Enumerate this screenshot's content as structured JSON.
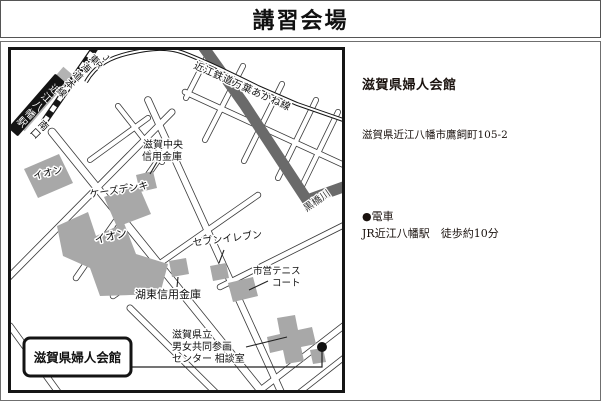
{
  "title": "講習会場",
  "info_panel": {
    "name": "滋賀県婦人会館",
    "address": "滋賀県近江八幡市鷹飼町105-2",
    "access_heading": "●電車",
    "access_detail": "JR近江八幡駅　徒歩約10分"
  },
  "map": {
    "venue_label": "滋賀県婦人会館",
    "station_label": "近江八幡駅",
    "south_exit_label": "南口",
    "jr_prefix": "JR",
    "jr_line_label": "東海道本線",
    "ohmi_line_label": "近江鉄道万葉あかね線",
    "river_label": "黒橋川",
    "labels": {
      "aeon_small": "イオン",
      "aeon_big": "イオン",
      "ks_denki": "ケーズデンキ",
      "chuo_shinkin_1": "滋賀中央",
      "chuo_shinkin_2": "信用金庫",
      "seven_eleven": "セブンイレブン",
      "tennis_1": "市営テニス",
      "tennis_2": "コート",
      "koto_shinkin": "湖東信用金庫",
      "center_1": "滋賀県立",
      "center_2": "男女共同参画",
      "center_3": "センター 相談室"
    },
    "colors": {
      "building": "#a8a8a8",
      "river": "#6a6a6a",
      "rail": "#161616",
      "platform": "#b3b3b3"
    }
  }
}
